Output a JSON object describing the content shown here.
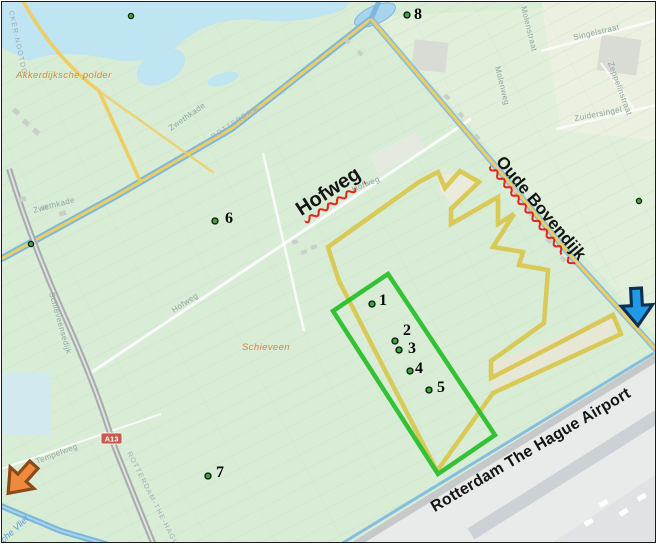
{
  "annotations": {
    "road_labels": [
      {
        "text": "Hofweg",
        "underline": true
      },
      {
        "text": "Oude Bovendijk",
        "underline": true
      },
      {
        "text": "Rotterdam The Hague Airport",
        "underline": false
      }
    ],
    "points": [
      {
        "label": "1",
        "x": 371,
        "y": 303,
        "dx": 7,
        "dy": 1
      },
      {
        "label": "2",
        "x": 394,
        "y": 340,
        "dx": 8,
        "dy": -6
      },
      {
        "label": "3",
        "x": 398,
        "y": 349,
        "dx": 9,
        "dy": 3
      },
      {
        "label": "4",
        "x": 409,
        "y": 370,
        "dx": 5,
        "dy": 2
      },
      {
        "label": "5",
        "x": 428,
        "y": 389,
        "dx": 8,
        "dy": 2
      },
      {
        "label": "6",
        "x": 214,
        "y": 220,
        "dx": 10,
        "dy": 2
      },
      {
        "label": "7",
        "x": 207,
        "y": 475,
        "dx": 8,
        "dy": 1
      },
      {
        "label": "8",
        "x": 406,
        "y": 14,
        "dx": 7,
        "dy": 4
      }
    ],
    "extra_dots": [
      {
        "x": 130,
        "y": 15
      },
      {
        "x": 638,
        "y": 200
      },
      {
        "x": 30,
        "y": 243
      }
    ],
    "marker_style": {
      "fill": "#2fae2f",
      "stroke": "#111111",
      "radius": 3
    },
    "green_rectangle": {
      "color": "#35c135",
      "width": 4.5,
      "points": [
        [
          387,
          273
        ],
        [
          332,
          310
        ],
        [
          437,
          473
        ],
        [
          494,
          434
        ]
      ]
    },
    "yellow_polygon": {
      "color": "#d9c54b",
      "width": 4.5,
      "points": [
        [
          418,
          181
        ],
        [
          437,
          171
        ],
        [
          444,
          187
        ],
        [
          459,
          170
        ],
        [
          478,
          181
        ],
        [
          450,
          208
        ],
        [
          450,
          223
        ],
        [
          497,
          196
        ],
        [
          497,
          223
        ],
        [
          513,
          213
        ],
        [
          492,
          246
        ],
        [
          522,
          251
        ],
        [
          518,
          264
        ],
        [
          547,
          269
        ],
        [
          543,
          322
        ],
        [
          490,
          360
        ],
        [
          490,
          377
        ],
        [
          612,
          314
        ],
        [
          620,
          333
        ],
        [
          492,
          392
        ],
        [
          436,
          470
        ],
        [
          338,
          280
        ],
        [
          331,
          259
        ],
        [
          327,
          246
        ]
      ]
    },
    "arrows": [
      {
        "name": "blue-arrow",
        "fill": "#1e9be6",
        "outline": "#0e2f52",
        "x": 636,
        "y": 306,
        "rotation": -3,
        "scale": 0.78
      },
      {
        "name": "orange-arrow",
        "fill": "#ee8a3c",
        "outline": "#8a4a1a",
        "x": 20,
        "y": 478,
        "rotation": 42,
        "scale": 0.8
      }
    ]
  },
  "base_map": {
    "area_labels": [
      {
        "text": "Akkerdijksche polder"
      },
      {
        "text": "Schieveen"
      }
    ],
    "street_labels": [
      "CKER-NOOTDO",
      "Zwethkade",
      "Zwethkade",
      "ROTTERDAM",
      "Hofweg",
      "Hofweg",
      "Singelstraat",
      "Zeppelinstraat",
      "Zuidersingel",
      "Molenstraat",
      "Molenweg",
      "Schieveensedijk",
      "Tempelweg",
      "ROTTERDAM-THE-HAGUE-A",
      "che Vliet"
    ],
    "badge": "A13",
    "colors": {
      "land": "#d9ecd5",
      "water": "#bfe4f2",
      "canal": "#7db8dc",
      "road_yellow": "#efcd60",
      "airport": "#e9eaea"
    }
  }
}
